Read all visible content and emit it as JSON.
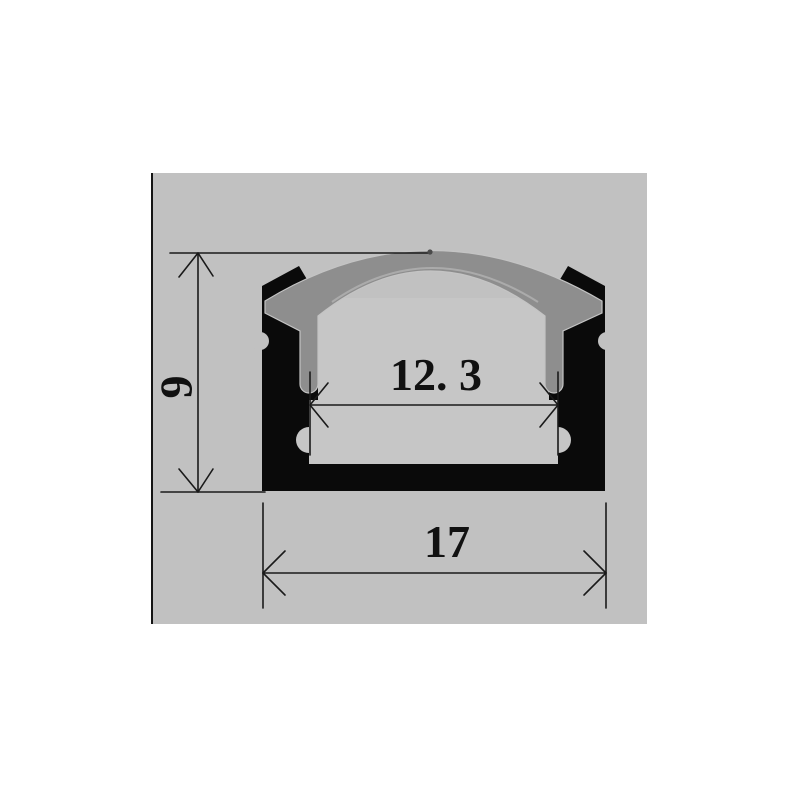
{
  "drawing": {
    "title": "LED aluminum channel profile cross-section dimension drawing",
    "dimensions": {
      "height_label": "9",
      "inner_width_label": "12. 3",
      "outer_width_label": "17"
    },
    "colors": {
      "page_bg": "#ffffff",
      "canvas_bg": "#c1c1c1",
      "canvas_border": "#151515",
      "profile_black": "#0a0a0a",
      "diffuser_gray": "#8e8e8e",
      "cavity_gray": "#c6c6c6",
      "dimension_line": "#1a1a1a"
    }
  }
}
